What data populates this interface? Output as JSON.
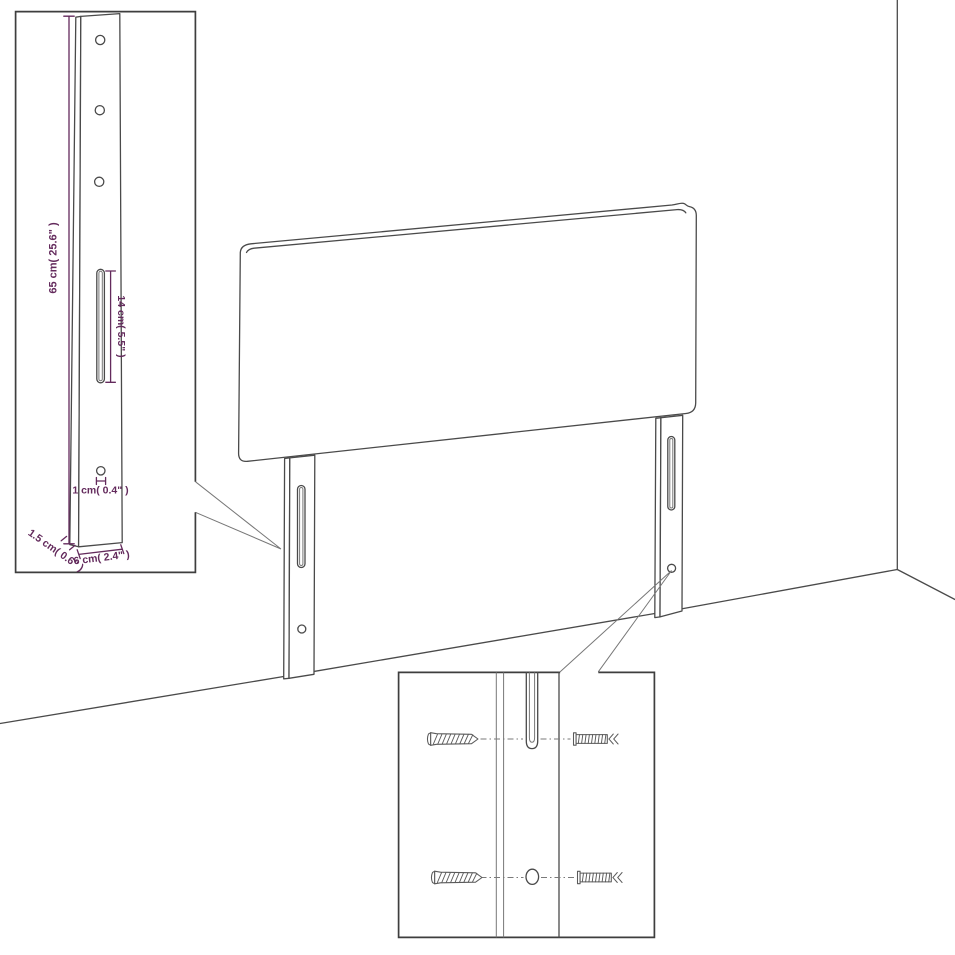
{
  "labels": {
    "leg_height": "65 cm( 25.6\" )",
    "slot_length": "14 cm( 5.5\" )",
    "hole_diameter": "1 cm( 0.4\" )",
    "leg_thickness": "1.5 cm( 0.6\" )",
    "leg_width": "6 cm( 2.4\" )"
  },
  "colors": {
    "accent": "#632a5c",
    "line": "#4a4a4a"
  },
  "icons": {
    "screw": "screw-icon",
    "wall_plug": "wall-plug-icon"
  }
}
